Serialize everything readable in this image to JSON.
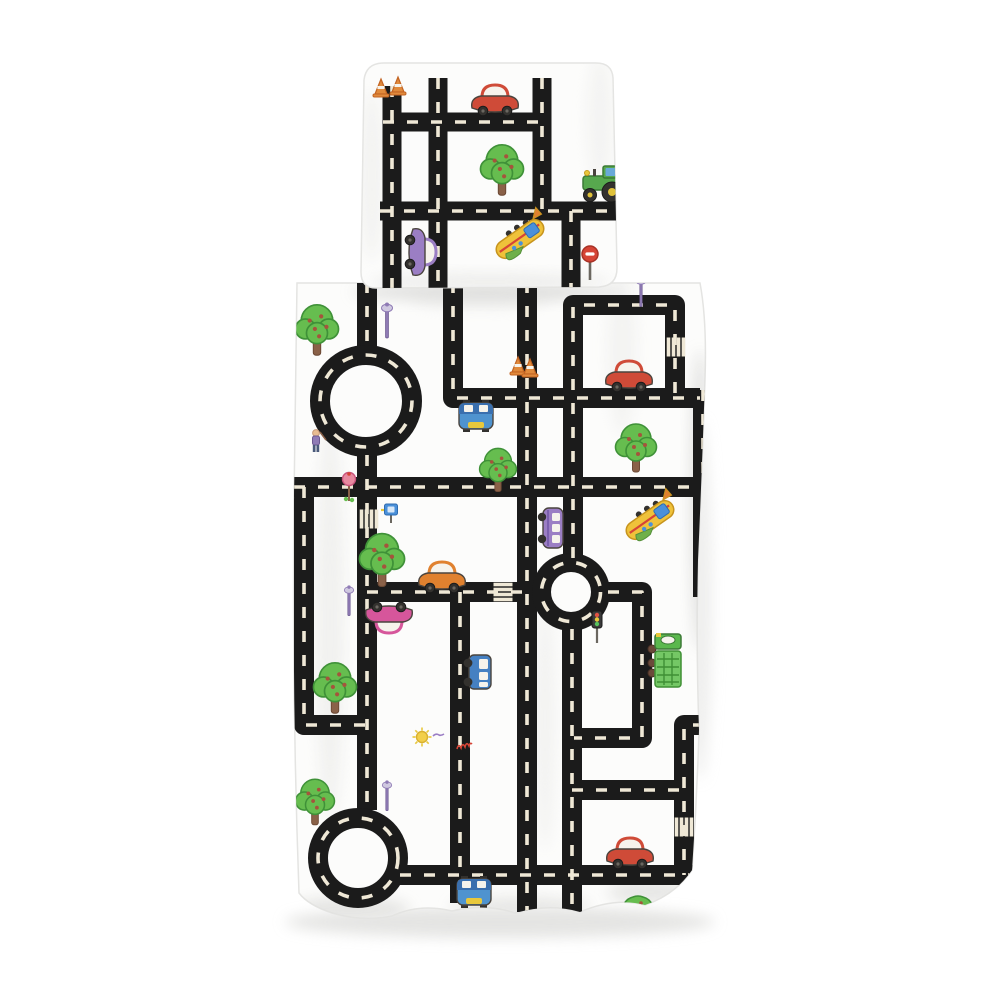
{
  "product": {
    "description": "Kids bedding set photo: white duvet cover and pillowcase printed with a black road-map of streets, roundabouts, zebra crossings, cars, trucks, planes, trees and traffic signs"
  },
  "palette": {
    "page": "#ffffff",
    "fabric": "#fcfcfb",
    "fabricEdge": "#e4e4e2",
    "shadow": "#dededc",
    "road": "#1b1b1b",
    "dash": "#efe8d6",
    "outline": "#4a443e",
    "carRed": "#cf4b38",
    "carOrange": "#e0812f",
    "carMagenta": "#d6569b",
    "carPurple": "#9b7ec4",
    "vanBlue": "#4580c2",
    "topcarBlue": "#4f93cf",
    "truckGreen": "#5bb84d",
    "containerGreen": "#74c765",
    "treeGreen": "#66bd4f",
    "treeEdge": "#3f9138",
    "trunk": "#8a6148",
    "fruitDot": "#a5543c",
    "coneOrange": "#e08a3c",
    "signRed": "#d64436",
    "signPink": "#e88aa0",
    "signBlue": "#4a90d9",
    "lampPurple": "#8f7bb5",
    "sunYellow": "#f2cf4a",
    "planeYellow": "#efc23a",
    "planeGreen": "#6fb04a",
    "wheel": "#33312e",
    "white": "#f6f3ec"
  },
  "roadWidth": {
    "pillow": 19,
    "duvet": 20
  },
  "dashStyle": {
    "width": 3.6,
    "pattern": "11 13"
  },
  "pillow": {
    "outline": "M364,80 Q366,63 384,63 L594,63 Q612,62 613,78 L617,268 Q617,286 599,287 L376,288 Q361,288 361,272 Z",
    "roads": [
      {
        "name": "pillow-road-left-vertical",
        "pts": [
          [
            392,
            86
          ],
          [
            392,
            290
          ]
        ]
      },
      {
        "name": "pillow-road-mid-vertical",
        "pts": [
          [
            438,
            78
          ],
          [
            438,
            290
          ]
        ]
      },
      {
        "name": "pillow-road-top-horizontal",
        "pts": [
          [
            383,
            122
          ],
          [
            542,
            122
          ]
        ]
      },
      {
        "name": "pillow-road-right-vertical",
        "pts": [
          [
            542,
            78
          ],
          [
            542,
            211
          ]
        ]
      },
      {
        "name": "pillow-road-cross-horizontal",
        "pts": [
          [
            380,
            211
          ],
          [
            617,
            211
          ]
        ]
      },
      {
        "name": "pillow-road-lower-vertical",
        "pts": [
          [
            571,
            211
          ],
          [
            571,
            290
          ]
        ]
      }
    ],
    "items": [
      {
        "type": "cone",
        "x": 381,
        "y": 88
      },
      {
        "type": "cone",
        "x": 398,
        "y": 86
      },
      {
        "type": "car",
        "x": 495,
        "y": 101,
        "color": "carRed"
      },
      {
        "type": "tree",
        "x": 502,
        "y": 170,
        "s": 1.05
      },
      {
        "type": "tractor",
        "x": 601,
        "y": 186
      },
      {
        "type": "plane",
        "x": 520,
        "y": 239
      },
      {
        "type": "car",
        "x": 420,
        "y": 252,
        "color": "carPurple",
        "rot": 90
      },
      {
        "type": "sign-noentry",
        "x": 590,
        "y": 262
      }
    ]
  },
  "duvet": {
    "outline": "M297,283 L700,283 Q707,320 705,380 Q702,470 698,560 Q696,650 699,730 Q697,800 692,870 Q675,895 645,905 Q615,897 580,912 Q550,903 515,913 Q485,903 452,911 Q420,903 392,916 Q362,922 332,913 Q308,905 299,893 Q292,700 294,500 Z",
    "roads": [
      {
        "name": "road-top-left-vertical",
        "pts": [
          [
            367,
            282
          ],
          [
            367,
            348
          ]
        ]
      },
      {
        "name": "road-roundabout-south",
        "pts": [
          [
            367,
            455
          ],
          [
            367,
            810
          ]
        ]
      },
      {
        "name": "road-main-horizontal",
        "pts": [
          [
            294,
            487
          ],
          [
            700,
            487
          ]
        ]
      },
      {
        "name": "road-upper-elbow",
        "pts": [
          [
            453,
            282
          ],
          [
            453,
            398
          ],
          [
            700,
            398
          ]
        ]
      },
      {
        "name": "road-center-vertical",
        "pts": [
          [
            527,
            282
          ],
          [
            527,
            912
          ]
        ]
      },
      {
        "name": "road-top-right-loop",
        "pts": [
          [
            573,
            558
          ],
          [
            573,
            305
          ],
          [
            675,
            305
          ],
          [
            675,
            398
          ]
        ]
      },
      {
        "name": "road-mid-horizontal",
        "pts": [
          [
            367,
            592
          ],
          [
            534,
            592
          ]
        ]
      },
      {
        "name": "road-lower-right-loop",
        "pts": [
          [
            608,
            592
          ],
          [
            642,
            592
          ],
          [
            642,
            738
          ],
          [
            574,
            738
          ]
        ]
      },
      {
        "name": "road-lower-vertical",
        "pts": [
          [
            572,
            629
          ],
          [
            572,
            915
          ]
        ]
      },
      {
        "name": "road-low-horizontal",
        "pts": [
          [
            572,
            790
          ],
          [
            684,
            790
          ]
        ]
      },
      {
        "name": "road-right-elbow",
        "pts": [
          [
            704,
            725
          ],
          [
            684,
            725
          ],
          [
            684,
            875
          ]
        ]
      },
      {
        "name": "road-left-elbow",
        "pts": [
          [
            304,
            487
          ],
          [
            304,
            725
          ],
          [
            367,
            725
          ]
        ]
      },
      {
        "name": "road-mid-vertical",
        "pts": [
          [
            460,
            592
          ],
          [
            460,
            903
          ]
        ]
      },
      {
        "name": "road-bottom-horizontal",
        "pts": [
          [
            400,
            875
          ],
          [
            700,
            875
          ]
        ]
      },
      {
        "name": "road-right-edge",
        "pts": [
          [
            703,
            390
          ],
          [
            703,
            597
          ]
        ]
      }
    ],
    "roundabouts": [
      {
        "name": "roundabout-large",
        "cx": 366,
        "cy": 401,
        "rOuter": 56,
        "rInner": 36
      },
      {
        "name": "roundabout-small",
        "cx": 571,
        "cy": 592,
        "rOuter": 39,
        "rInner": 20
      },
      {
        "name": "roundabout-bottom",
        "cx": 358,
        "cy": 858,
        "rOuter": 50,
        "rInner": 30
      }
    ],
    "crosswalks": [
      {
        "x": 369,
        "y": 519,
        "axis": "v"
      },
      {
        "x": 503,
        "y": 592,
        "axis": "h"
      },
      {
        "x": 676,
        "y": 347,
        "axis": "v"
      },
      {
        "x": 684,
        "y": 827,
        "axis": "v"
      }
    ],
    "items": [
      {
        "type": "tree",
        "x": 317,
        "y": 330,
        "s": 1.05
      },
      {
        "type": "lamp",
        "x": 387,
        "y": 322
      },
      {
        "type": "person",
        "x": 316,
        "y": 442
      },
      {
        "type": "sign-lolly",
        "x": 349,
        "y": 487
      },
      {
        "type": "sign-square",
        "x": 391,
        "y": 511
      },
      {
        "type": "tree",
        "x": 382,
        "y": 560,
        "s": 1.1
      },
      {
        "type": "car",
        "x": 442,
        "y": 578,
        "color": "carOrange"
      },
      {
        "type": "car",
        "x": 389,
        "y": 617,
        "color": "carMagenta",
        "rot": 180
      },
      {
        "type": "lamp",
        "x": 349,
        "y": 602,
        "s": 0.85
      },
      {
        "type": "tree",
        "x": 498,
        "y": 470,
        "s": 0.9
      },
      {
        "type": "topcar",
        "x": 476,
        "y": 416
      },
      {
        "type": "cone",
        "x": 518,
        "y": 366
      },
      {
        "type": "cone",
        "x": 530,
        "y": 368
      },
      {
        "type": "car",
        "x": 629,
        "y": 377,
        "color": "carRed",
        "flip": true
      },
      {
        "type": "tree",
        "x": 636,
        "y": 448
      },
      {
        "type": "lamp",
        "x": 641,
        "y": 293,
        "s": 0.85
      },
      {
        "type": "bus",
        "x": 553,
        "y": 528,
        "rot": 90
      },
      {
        "type": "plane",
        "x": 650,
        "y": 520
      },
      {
        "type": "traffic-light",
        "x": 597,
        "y": 629
      },
      {
        "type": "garbage-truck",
        "x": 668,
        "y": 661
      },
      {
        "type": "sun",
        "x": 422,
        "y": 737
      },
      {
        "type": "squiggle",
        "x": 466,
        "y": 747
      },
      {
        "type": "tree",
        "x": 335,
        "y": 688,
        "s": 1.05
      },
      {
        "type": "tree",
        "x": 315,
        "y": 802,
        "s": 0.95
      },
      {
        "type": "lamp",
        "x": 387,
        "y": 797,
        "s": 0.85
      },
      {
        "type": "van",
        "x": 480,
        "y": 672,
        "rot": 90
      },
      {
        "type": "topcar",
        "x": 474,
        "y": 892
      },
      {
        "type": "car",
        "x": 630,
        "y": 854,
        "color": "carRed",
        "flip": true
      },
      {
        "type": "bush",
        "x": 638,
        "y": 906
      }
    ]
  }
}
